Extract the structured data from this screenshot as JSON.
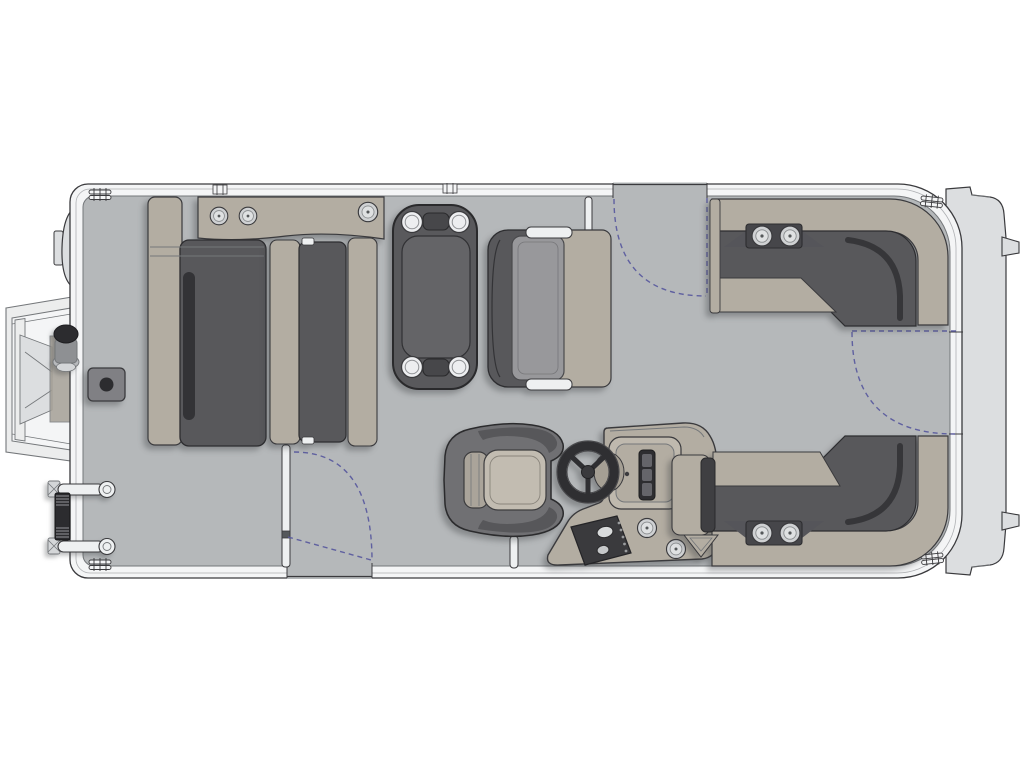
{
  "figure": {
    "type": "floorplan",
    "subject": "pontoon-boat-top-view",
    "orientation": "bow-left-stern-right"
  },
  "colors": {
    "page_bg": "#ffffff",
    "deck": "#b5b8ba",
    "rail_white": "#f4f5f6",
    "outline": "#3a3a3d",
    "outline_soft": "#74777a",
    "hull_light": "#dcdee0",
    "hull_lighter": "#eceded",
    "tan": "#b3ada2",
    "tan_dark": "#a5a096",
    "cushion_dark": "#58585b",
    "cushion_black": "#2d2d30",
    "cushion_gray": "#98989b",
    "cushion_light": "#c2bcb1",
    "chair_shell": "#707073",
    "chair_shell_dark": "#57575a",
    "table_dark": "#59595c",
    "table_inner": "#646467",
    "chrome": "#cfd1d3",
    "white_detail": "#eef0f1",
    "dark_panel": "#3a3a3d",
    "grip_dark": "#2c2c2f",
    "pad_gray": "#808084",
    "pad_dot": "#2c2c2f",
    "gauge_dark": "#2e2e31",
    "gauge_bar": "#65656a",
    "gate_dash": "#5b5b9e"
  },
  "components": [
    {
      "id": "bow-boarding-gate",
      "label": "Bow boarding gate shown open",
      "cup_holders": 0
    },
    {
      "id": "bow-light-pylon",
      "label": "Bow navigation light pylon",
      "cup_holders": 0
    },
    {
      "id": "boarding-ladder",
      "label": "Port bow boarding ladder",
      "cup_holders": 0
    },
    {
      "id": "deck-pad",
      "label": "Deck mount pad",
      "cup_holders": 0
    },
    {
      "id": "port-bow-lounge",
      "label": "Port bow lounge group with armrest console",
      "cup_holders": 3
    },
    {
      "id": "facing-bench",
      "label": "Facing bench seat beside lounge",
      "cup_holders": 0
    },
    {
      "id": "cocktail-table",
      "label": "Removable cocktail table",
      "cup_holders": 4
    },
    {
      "id": "aft-facing-bench",
      "label": "Aft-facing bench seat",
      "cup_holders": 0
    },
    {
      "id": "side-gate",
      "label": "Port side gate with swing arc",
      "cup_holders": 0
    },
    {
      "id": "mid-gate",
      "label": "Starboard mid gate shown open with swing arc",
      "cup_holders": 0
    },
    {
      "id": "stern-gate",
      "label": "Stern gate with swing arc",
      "cup_holders": 0
    },
    {
      "id": "starboard-stern-lounge",
      "label": "Aft L-lounge, forward side",
      "cup_holders": 2
    },
    {
      "id": "port-stern-lounge",
      "label": "Aft L-lounge, aft side",
      "cup_holders": 2
    },
    {
      "id": "helm-console",
      "label": "Helm console with steering wheel and switch panel",
      "cup_holders": 2
    },
    {
      "id": "captain-chair",
      "label": "Captain's helm chair",
      "cup_holders": 0
    },
    {
      "id": "stern-platform",
      "label": "Stern platform with motor mounts",
      "cup_holders": 0
    }
  ]
}
